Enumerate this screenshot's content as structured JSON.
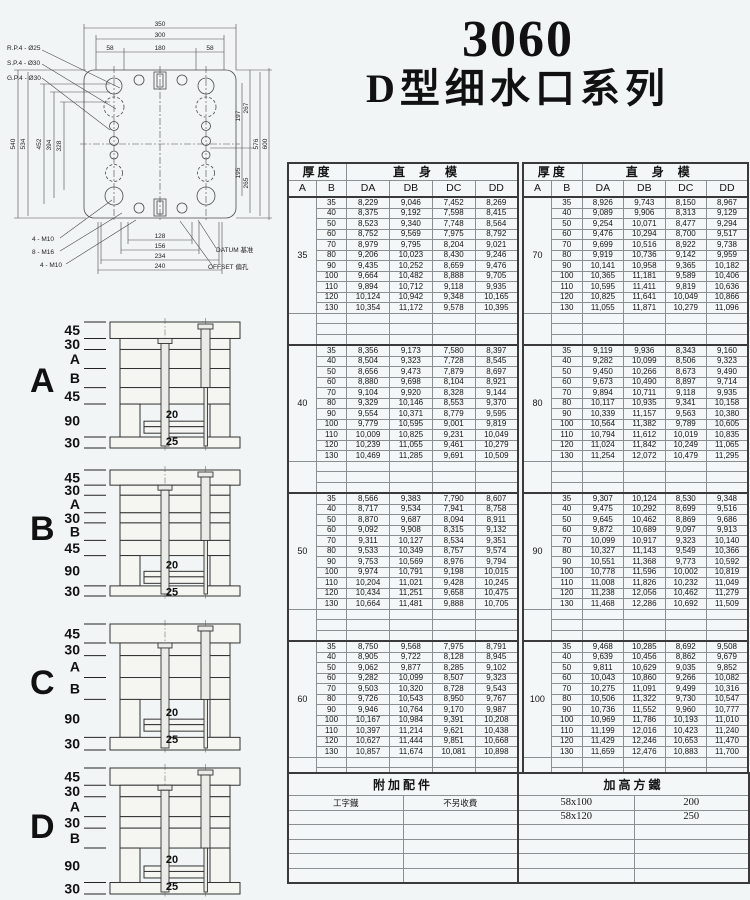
{
  "title": {
    "line1": "3060",
    "line2": "D型细水口系列"
  },
  "drawing": {
    "top_dims": [
      "350",
      "300",
      "58",
      "180",
      "58"
    ],
    "left_dims": [
      "540",
      "534",
      "452",
      "394",
      "328"
    ],
    "right_dims": [
      "267",
      "197",
      "195",
      "265",
      "576",
      "600"
    ],
    "bottom_dims": [
      "128",
      "156",
      "234",
      "240"
    ],
    "leader_labels": [
      "R.P.4 - Ø25",
      "S.P.4 - Ø30",
      "G.P.4 - Ø30",
      "4 - M10",
      "8 - M16",
      "4 - M10"
    ],
    "datum_label": "DATUM 基准",
    "offset_label": "OFFSET 偏孔"
  },
  "sections": [
    {
      "label": "A",
      "dims": [
        "45",
        "30",
        "A",
        "B",
        "45",
        "90",
        "30"
      ],
      "inner": [
        "20",
        "25"
      ]
    },
    {
      "label": "B",
      "dims": [
        "45",
        "30",
        "A",
        "30",
        "B",
        "45",
        "90",
        "30"
      ],
      "inner": [
        "20",
        "25"
      ]
    },
    {
      "label": "C",
      "dims": [
        "45",
        "30",
        "A",
        "B",
        "90",
        "30"
      ],
      "inner": [
        "20",
        "25"
      ]
    },
    {
      "label": "D",
      "dims": [
        "45",
        "30",
        "A",
        "30",
        "B",
        "90",
        "30"
      ],
      "inner": [
        "20",
        "25"
      ]
    }
  ],
  "tables": [
    {
      "header": {
        "thickness": "厚度",
        "mold_type": "直身模",
        "cols": [
          "A",
          "B",
          "DA",
          "DB",
          "DC",
          "DD"
        ]
      },
      "blocks": [
        {
          "a": "35",
          "rows": [
            [
              "35",
              "8,229",
              "9,046",
              "7,452",
              "8,269"
            ],
            [
              "40",
              "8,375",
              "9,192",
              "7,598",
              "8,415"
            ],
            [
              "50",
              "8,523",
              "9,340",
              "7,748",
              "8,564"
            ],
            [
              "60",
              "8,752",
              "9,569",
              "7,975",
              "8,792"
            ],
            [
              "70",
              "8,979",
              "9,795",
              "8,204",
              "9,021"
            ],
            [
              "80",
              "9,206",
              "10,023",
              "8,430",
              "9,246"
            ],
            [
              "90",
              "9,435",
              "10,252",
              "8,659",
              "9,476"
            ],
            [
              "100",
              "9,664",
              "10,482",
              "8,888",
              "9,705"
            ],
            [
              "110",
              "9,894",
              "10,712",
              "9,118",
              "9,935"
            ],
            [
              "120",
              "10,124",
              "10,942",
              "9,348",
              "10,165"
            ],
            [
              "130",
              "10,354",
              "11,172",
              "9,578",
              "10,395"
            ]
          ]
        },
        {
          "a": "40",
          "rows": [
            [
              "35",
              "8,356",
              "9,173",
              "7,580",
              "8,397"
            ],
            [
              "40",
              "8,504",
              "9,323",
              "7,728",
              "8,545"
            ],
            [
              "50",
              "8,656",
              "9,473",
              "7,879",
              "8,697"
            ],
            [
              "60",
              "8,880",
              "9,698",
              "8,104",
              "8,921"
            ],
            [
              "70",
              "9,104",
              "9,920",
              "8,328",
              "9,144"
            ],
            [
              "80",
              "9,329",
              "10,146",
              "8,553",
              "9,370"
            ],
            [
              "90",
              "9,554",
              "10,371",
              "8,779",
              "9,595"
            ],
            [
              "100",
              "9,779",
              "10,595",
              "9,001",
              "9,819"
            ],
            [
              "110",
              "10,009",
              "10,825",
              "9,231",
              "10,049"
            ],
            [
              "120",
              "10,239",
              "11,055",
              "9,461",
              "10,279"
            ],
            [
              "130",
              "10,469",
              "11,285",
              "9,691",
              "10,509"
            ]
          ]
        },
        {
          "a": "50",
          "rows": [
            [
              "35",
              "8,566",
              "9,383",
              "7,790",
              "8,607"
            ],
            [
              "40",
              "8,717",
              "9,534",
              "7,941",
              "8,758"
            ],
            [
              "50",
              "8,870",
              "9,687",
              "8,094",
              "8,911"
            ],
            [
              "60",
              "9,092",
              "9,908",
              "8,315",
              "9,132"
            ],
            [
              "70",
              "9,311",
              "10,127",
              "8,534",
              "9,351"
            ],
            [
              "80",
              "9,533",
              "10,349",
              "8,757",
              "9,574"
            ],
            [
              "90",
              "9,753",
              "10,569",
              "8,976",
              "9,794"
            ],
            [
              "100",
              "9,974",
              "10,791",
              "9,198",
              "10,015"
            ],
            [
              "110",
              "10,204",
              "11,021",
              "9,428",
              "10,245"
            ],
            [
              "120",
              "10,434",
              "11,251",
              "9,658",
              "10,475"
            ],
            [
              "130",
              "10,664",
              "11,481",
              "9,888",
              "10,705"
            ]
          ]
        },
        {
          "a": "60",
          "rows": [
            [
              "35",
              "8,750",
              "9,568",
              "7,975",
              "8,791"
            ],
            [
              "40",
              "8,905",
              "9,722",
              "8,128",
              "8,945"
            ],
            [
              "50",
              "9,062",
              "9,877",
              "8,285",
              "9,102"
            ],
            [
              "60",
              "9,282",
              "10,099",
              "8,507",
              "9,323"
            ],
            [
              "70",
              "9,503",
              "10,320",
              "8,728",
              "9,543"
            ],
            [
              "80",
              "9,726",
              "10,543",
              "8,950",
              "9,767"
            ],
            [
              "90",
              "9,946",
              "10,764",
              "9,170",
              "9,987"
            ],
            [
              "100",
              "10,167",
              "10,984",
              "9,391",
              "10,208"
            ],
            [
              "110",
              "10,397",
              "11,214",
              "9,621",
              "10,438"
            ],
            [
              "120",
              "10,627",
              "11,444",
              "9,851",
              "10,668"
            ],
            [
              "130",
              "10,857",
              "11,674",
              "10,081",
              "10,898"
            ]
          ]
        }
      ]
    },
    {
      "header": {
        "thickness": "厚度",
        "mold_type": "直身模",
        "cols": [
          "A",
          "B",
          "DA",
          "DB",
          "DC",
          "DD"
        ]
      },
      "blocks": [
        {
          "a": "70",
          "rows": [
            [
              "35",
              "8,926",
              "9,743",
              "8,150",
              "8,967"
            ],
            [
              "40",
              "9,089",
              "9,906",
              "8,313",
              "9,129"
            ],
            [
              "50",
              "9,254",
              "10,071",
              "8,477",
              "9,294"
            ],
            [
              "60",
              "9,476",
              "10,294",
              "8,700",
              "9,517"
            ],
            [
              "70",
              "9,699",
              "10,516",
              "8,922",
              "9,738"
            ],
            [
              "80",
              "9,919",
              "10,736",
              "9,142",
              "9,959"
            ],
            [
              "90",
              "10,141",
              "10,958",
              "9,365",
              "10,182"
            ],
            [
              "100",
              "10,365",
              "11,181",
              "9,589",
              "10,406"
            ],
            [
              "110",
              "10,595",
              "11,411",
              "9,819",
              "10,636"
            ],
            [
              "120",
              "10,825",
              "11,641",
              "10,049",
              "10,866"
            ],
            [
              "130",
              "11,055",
              "11,871",
              "10,279",
              "11,096"
            ]
          ]
        },
        {
          "a": "80",
          "rows": [
            [
              "35",
              "9,119",
              "9,936",
              "8,343",
              "9,160"
            ],
            [
              "40",
              "9,282",
              "10,099",
              "8,506",
              "9,323"
            ],
            [
              "50",
              "9,450",
              "10,266",
              "8,673",
              "9,490"
            ],
            [
              "60",
              "9,673",
              "10,490",
              "8,897",
              "9,714"
            ],
            [
              "70",
              "9,894",
              "10,711",
              "9,118",
              "9,935"
            ],
            [
              "80",
              "10,117",
              "10,935",
              "9,341",
              "10,158"
            ],
            [
              "90",
              "10,339",
              "11,157",
              "9,563",
              "10,380"
            ],
            [
              "100",
              "10,564",
              "11,382",
              "9,789",
              "10,605"
            ],
            [
              "110",
              "10,794",
              "11,612",
              "10,019",
              "10,835"
            ],
            [
              "120",
              "11,024",
              "11,842",
              "10,249",
              "11,065"
            ],
            [
              "130",
              "11,254",
              "12,072",
              "10,479",
              "11,295"
            ]
          ]
        },
        {
          "a": "90",
          "rows": [
            [
              "35",
              "9,307",
              "10,124",
              "8,530",
              "9,348"
            ],
            [
              "40",
              "9,475",
              "10,292",
              "8,699",
              "9,516"
            ],
            [
              "50",
              "9,645",
              "10,462",
              "8,869",
              "9,686"
            ],
            [
              "60",
              "9,872",
              "10,689",
              "9,097",
              "9,913"
            ],
            [
              "70",
              "10,099",
              "10,917",
              "9,323",
              "10,140"
            ],
            [
              "80",
              "10,327",
              "11,143",
              "9,549",
              "10,366"
            ],
            [
              "90",
              "10,551",
              "11,368",
              "9,773",
              "10,592"
            ],
            [
              "100",
              "10,778",
              "11,596",
              "10,002",
              "10,819"
            ],
            [
              "110",
              "11,008",
              "11,826",
              "10,232",
              "11,049"
            ],
            [
              "120",
              "11,238",
              "12,056",
              "10,462",
              "11,279"
            ],
            [
              "130",
              "11,468",
              "12,286",
              "10,692",
              "11,509"
            ]
          ]
        },
        {
          "a": "100",
          "rows": [
            [
              "35",
              "9,468",
              "10,285",
              "8,692",
              "9,508"
            ],
            [
              "40",
              "9,639",
              "10,456",
              "8,862",
              "9,679"
            ],
            [
              "50",
              "9,811",
              "10,629",
              "9,035",
              "9,852"
            ],
            [
              "60",
              "10,043",
              "10,860",
              "9,266",
              "10,082"
            ],
            [
              "70",
              "10,275",
              "11,091",
              "9,499",
              "10,316"
            ],
            [
              "80",
              "10,506",
              "11,322",
              "9,730",
              "10,547"
            ],
            [
              "90",
              "10,736",
              "11,552",
              "9,960",
              "10,777"
            ],
            [
              "100",
              "10,969",
              "11,786",
              "10,193",
              "11,010"
            ],
            [
              "110",
              "11,199",
              "12,016",
              "10,423",
              "11,240"
            ],
            [
              "120",
              "11,429",
              "12,246",
              "10,653",
              "11,470"
            ],
            [
              "130",
              "11,659",
              "12,476",
              "10,883",
              "11,700"
            ]
          ]
        }
      ]
    }
  ],
  "accessory": {
    "left_header": "附加配件",
    "right_header": "加高方鐵",
    "rows": [
      [
        "工字鐡",
        "不另收費",
        "58x100",
        "200"
      ],
      [
        "",
        "",
        "58x120",
        "250"
      ]
    ]
  }
}
